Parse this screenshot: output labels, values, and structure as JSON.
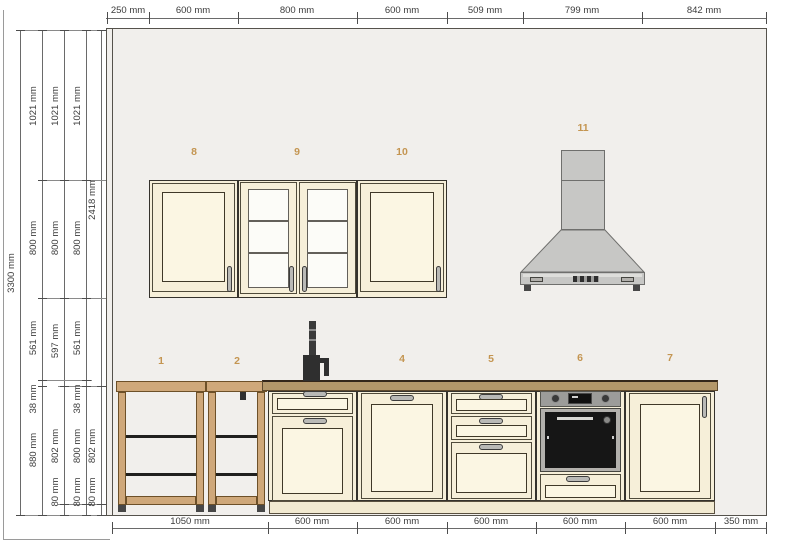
{
  "dimensions": {
    "top": [
      "250 mm",
      "600 mm",
      "800 mm",
      "600 mm",
      "509 mm",
      "799 mm",
      "842 mm"
    ],
    "bottom": [
      "1050 mm",
      "600 mm",
      "600 mm",
      "600 mm",
      "600 mm",
      "600 mm",
      "350 mm"
    ],
    "left_total": "3300 mm",
    "chain_b": [
      "1021 mm",
      "800 mm",
      "561 mm",
      "38 mm",
      "880 mm"
    ],
    "chain_c": [
      "1021 mm",
      "800 mm",
      "597 mm",
      "802 mm",
      "80 mm"
    ],
    "chain_d": [
      "1021 mm",
      "800 mm",
      "561 mm",
      "38 mm",
      "800 mm",
      "80 mm"
    ],
    "chain_e": [
      "2418 mm",
      "802 mm",
      "80 mm"
    ]
  },
  "units": {
    "u1": "1",
    "u2": "2",
    "u4": "4",
    "u5": "5",
    "u6": "6",
    "u7": "7",
    "u8": "8",
    "u9": "9",
    "u10": "10",
    "u11": "11"
  },
  "colors": {
    "wall": "#f1efec",
    "cab": "#f6efd9",
    "panel": "#fbf6e3",
    "wood": "#cfa87a",
    "counter": "#b3976a",
    "hood": "#c7c7c5",
    "handle": "#b9b9b6",
    "label": "#c49551",
    "plinth": "#f2ead1",
    "ovenglass": "#161616",
    "steel": "#b2b0ac",
    "cpanel": "#9c9c9a"
  }
}
